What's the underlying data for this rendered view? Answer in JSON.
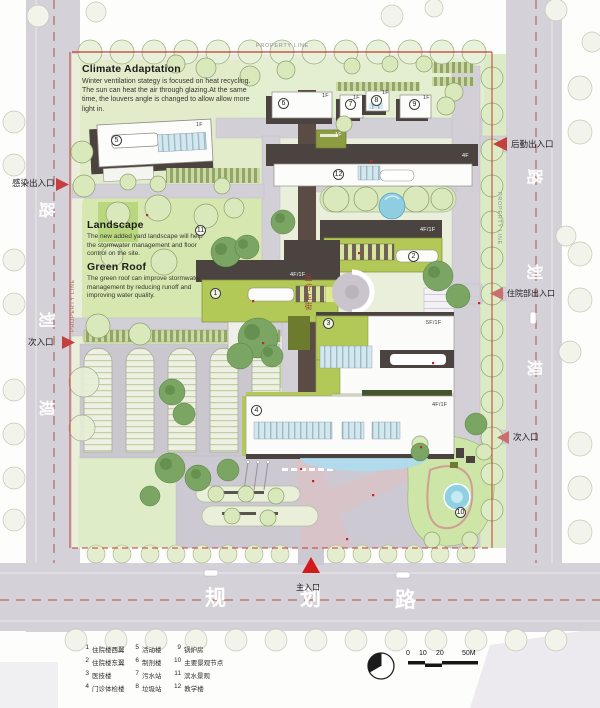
{
  "annotations": {
    "climate": {
      "title": "Climate Adaptation",
      "body": "Winter ventilation stategy is focused on heat recycling. The sun can heat the air through glazing.At the same time, the louvers angle is changed to allow allow more light in."
    },
    "landscape": {
      "title": "Landscape",
      "body": "The new added yard landscape will help the stormwater management and floor control on the site."
    },
    "green_roof": {
      "title": "Green Roof",
      "body": "The green roof can improve stormwater management by reducing runoff and improving water quality."
    }
  },
  "property_line_label": "PROPERTY LINE",
  "medical_street_label": "医疗主街",
  "roads": {
    "left": [
      "路",
      "划",
      "规"
    ],
    "right": [
      "路",
      "划",
      "规"
    ],
    "bottom": [
      "规",
      "划",
      "路"
    ]
  },
  "entrances": {
    "main": "主入口",
    "infection": "感染出入口",
    "secondary_left": "次入口",
    "logistics": "后勤出入口",
    "inpatient": "住院部出入口",
    "secondary_right": "次入口"
  },
  "buildings": {
    "numbers": [
      "1",
      "2",
      "3",
      "4",
      "5",
      "6",
      "7",
      "8",
      "9",
      "10",
      "11",
      "12"
    ],
    "floors": {
      "b1": "4F/1F",
      "b2": "4F/1F",
      "b3": "5F/1F",
      "b4": "4F/1F",
      "b5": "1F",
      "b6": "1F",
      "b7": "1F",
      "b8": "1F",
      "b9": "1F",
      "b12_wing": "1F",
      "b12": "4F"
    }
  },
  "legend": {
    "items": [
      {
        "num": "1",
        "label": "住院楼西翼"
      },
      {
        "num": "2",
        "label": "住院楼东翼"
      },
      {
        "num": "3",
        "label": "医技楼"
      },
      {
        "num": "4",
        "label": "门诊体检楼"
      },
      {
        "num": "5",
        "label": "活动楼"
      },
      {
        "num": "6",
        "label": "制剂楼"
      },
      {
        "num": "7",
        "label": "污水站"
      },
      {
        "num": "8",
        "label": "垃圾站"
      },
      {
        "num": "9",
        "label": "锅炉房"
      },
      {
        "num": "10",
        "label": "主要景观节点"
      },
      {
        "num": "11",
        "label": "滨水景观"
      },
      {
        "num": "12",
        "label": "教学楼"
      }
    ]
  },
  "scale": {
    "t0": "0",
    "t1": "10",
    "t2": "20",
    "t3": "50M"
  },
  "colors": {
    "accent_red": "#c4403c",
    "main_entrance_red": "#d31a1a",
    "green_roof": "#b2c957",
    "road": "#d5d1d9",
    "water": "#8fd0e2",
    "site_green": "#e9efdb"
  }
}
